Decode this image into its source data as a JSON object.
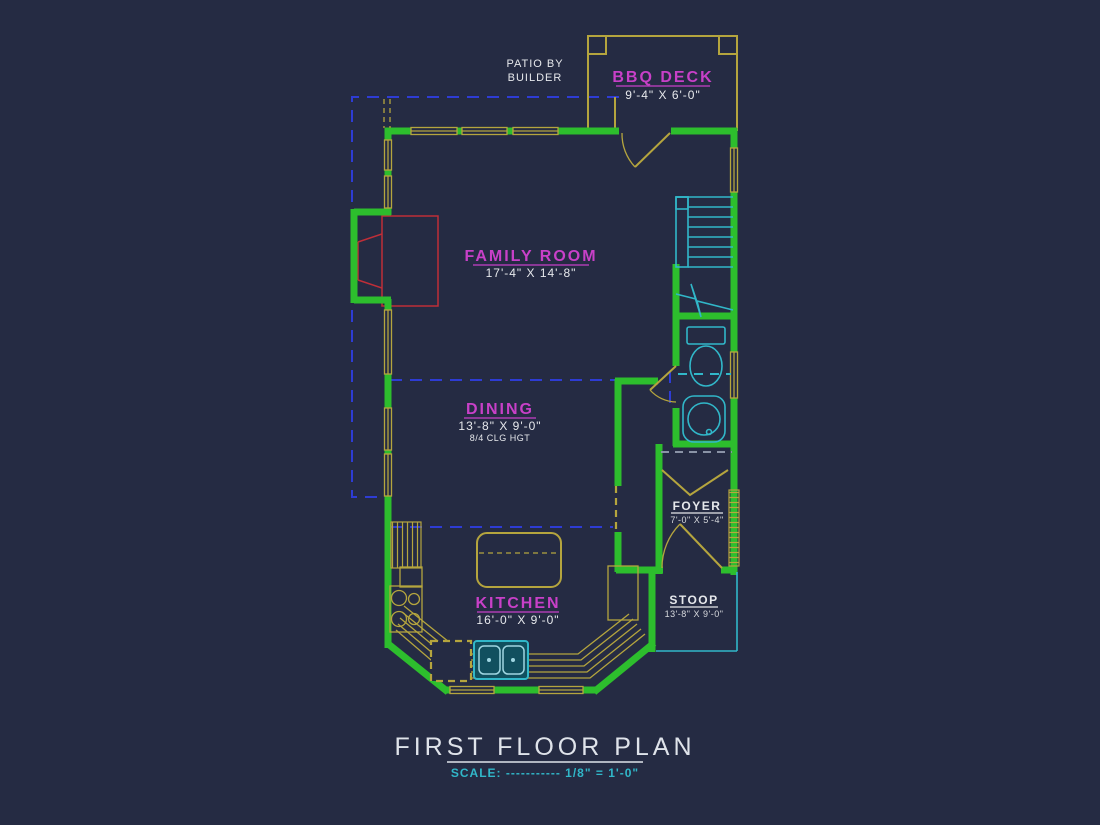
{
  "colors": {
    "background": "#252b43",
    "wall_green": "#2dbe2d",
    "fixture_yellow": "#b5a53e",
    "label_magenta": "#c840c8",
    "text_white": "#e6e8ec",
    "stair_cyan": "#31b7c9",
    "patio_dashed_blue": "#2e3cd4",
    "fireplace_red": "#bf2e38"
  },
  "annotations": {
    "patio_line1": "PATIO BY",
    "patio_line2": "BUILDER"
  },
  "rooms": [
    {
      "name": "BBQ DECK",
      "dims": "9'-4\" X 6'-0\""
    },
    {
      "name": "FAMILY ROOM",
      "dims": "17'-4\" X 14'-8\""
    },
    {
      "name": "DINING",
      "dims": "13'-8\" X 9'-0\"",
      "note": "8/4 CLG HGT"
    },
    {
      "name": "KITCHEN",
      "dims": "16'-0\" X 9'-0\""
    },
    {
      "name": "FOYER",
      "dims": "7'-0\" X 5'-4\""
    },
    {
      "name": "STOOP",
      "dims": "13'-8\" X 9'-0\""
    }
  ],
  "title_block": {
    "title": "FIRST FLOOR PLAN",
    "scale": "SCALE: ----------- 1/8\" = 1'-0\""
  }
}
